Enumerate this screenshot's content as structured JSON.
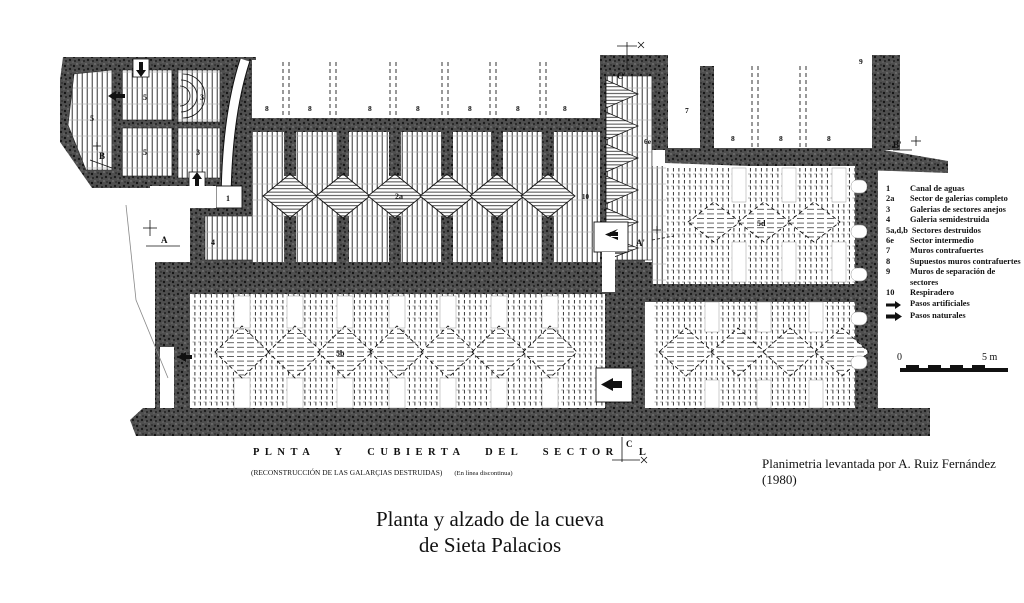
{
  "title": {
    "line1": "Planta y alzado de la cueva",
    "line2": "de Sieta Palacios"
  },
  "captions": {
    "plan_caption": "PLNTA Y CUBIERTA DEL SECTOR L",
    "reconstruction_note": "(RECONSTRUCCIÓN DE LAS GALARÇIAS DESTRUIDAS)",
    "dashed_note": "(En línea discontinua)",
    "attribution": "Planimetria levantada por A. Ruiz Fernández (1980)"
  },
  "scale_bar": {
    "zero": "0",
    "five": "5 m"
  },
  "section_markers": {
    "a": "A",
    "a_prime": "A'",
    "b": "B",
    "b_prime": "B'",
    "c": "C",
    "c_prime": "C'"
  },
  "plan_labels": {
    "canal": "1",
    "sector_completo": "2a",
    "galerias_anejas": "3",
    "galeria_semidestruida": "4",
    "sector5": "5",
    "sector5b": "5b",
    "sector5d": "5d",
    "sector_intermedio": "6e",
    "muro_contrafuerte": "7",
    "supuesto_muro": "8",
    "muro_separacion": "9",
    "respiradero": "10"
  },
  "legend": {
    "items": [
      {
        "key": "1",
        "label": "Canal de aguas"
      },
      {
        "key": "2a",
        "label": "Sector de galerias completo"
      },
      {
        "key": "3",
        "label": "Galerias de sectores anejos"
      },
      {
        "key": "4",
        "label": "Galeria semidestruida"
      },
      {
        "key": "5a,d,b",
        "label": "Sectores destruidos"
      },
      {
        "key": "6e",
        "label": "Sector intermedio"
      },
      {
        "key": "7",
        "label": "Muros contrafuertes"
      },
      {
        "key": "8",
        "label": "Supuestos muros contrafuertes"
      },
      {
        "key": "9",
        "label": "Muros de separación de sectores"
      },
      {
        "key": "10",
        "label": "Respiradero"
      }
    ],
    "passage_items": [
      {
        "label": "Pasos artificiales"
      },
      {
        "label": "Pasos naturales"
      }
    ]
  },
  "colors": {
    "ink": "#111111",
    "wall": "#4a4a4a",
    "paper": "#ffffff"
  }
}
